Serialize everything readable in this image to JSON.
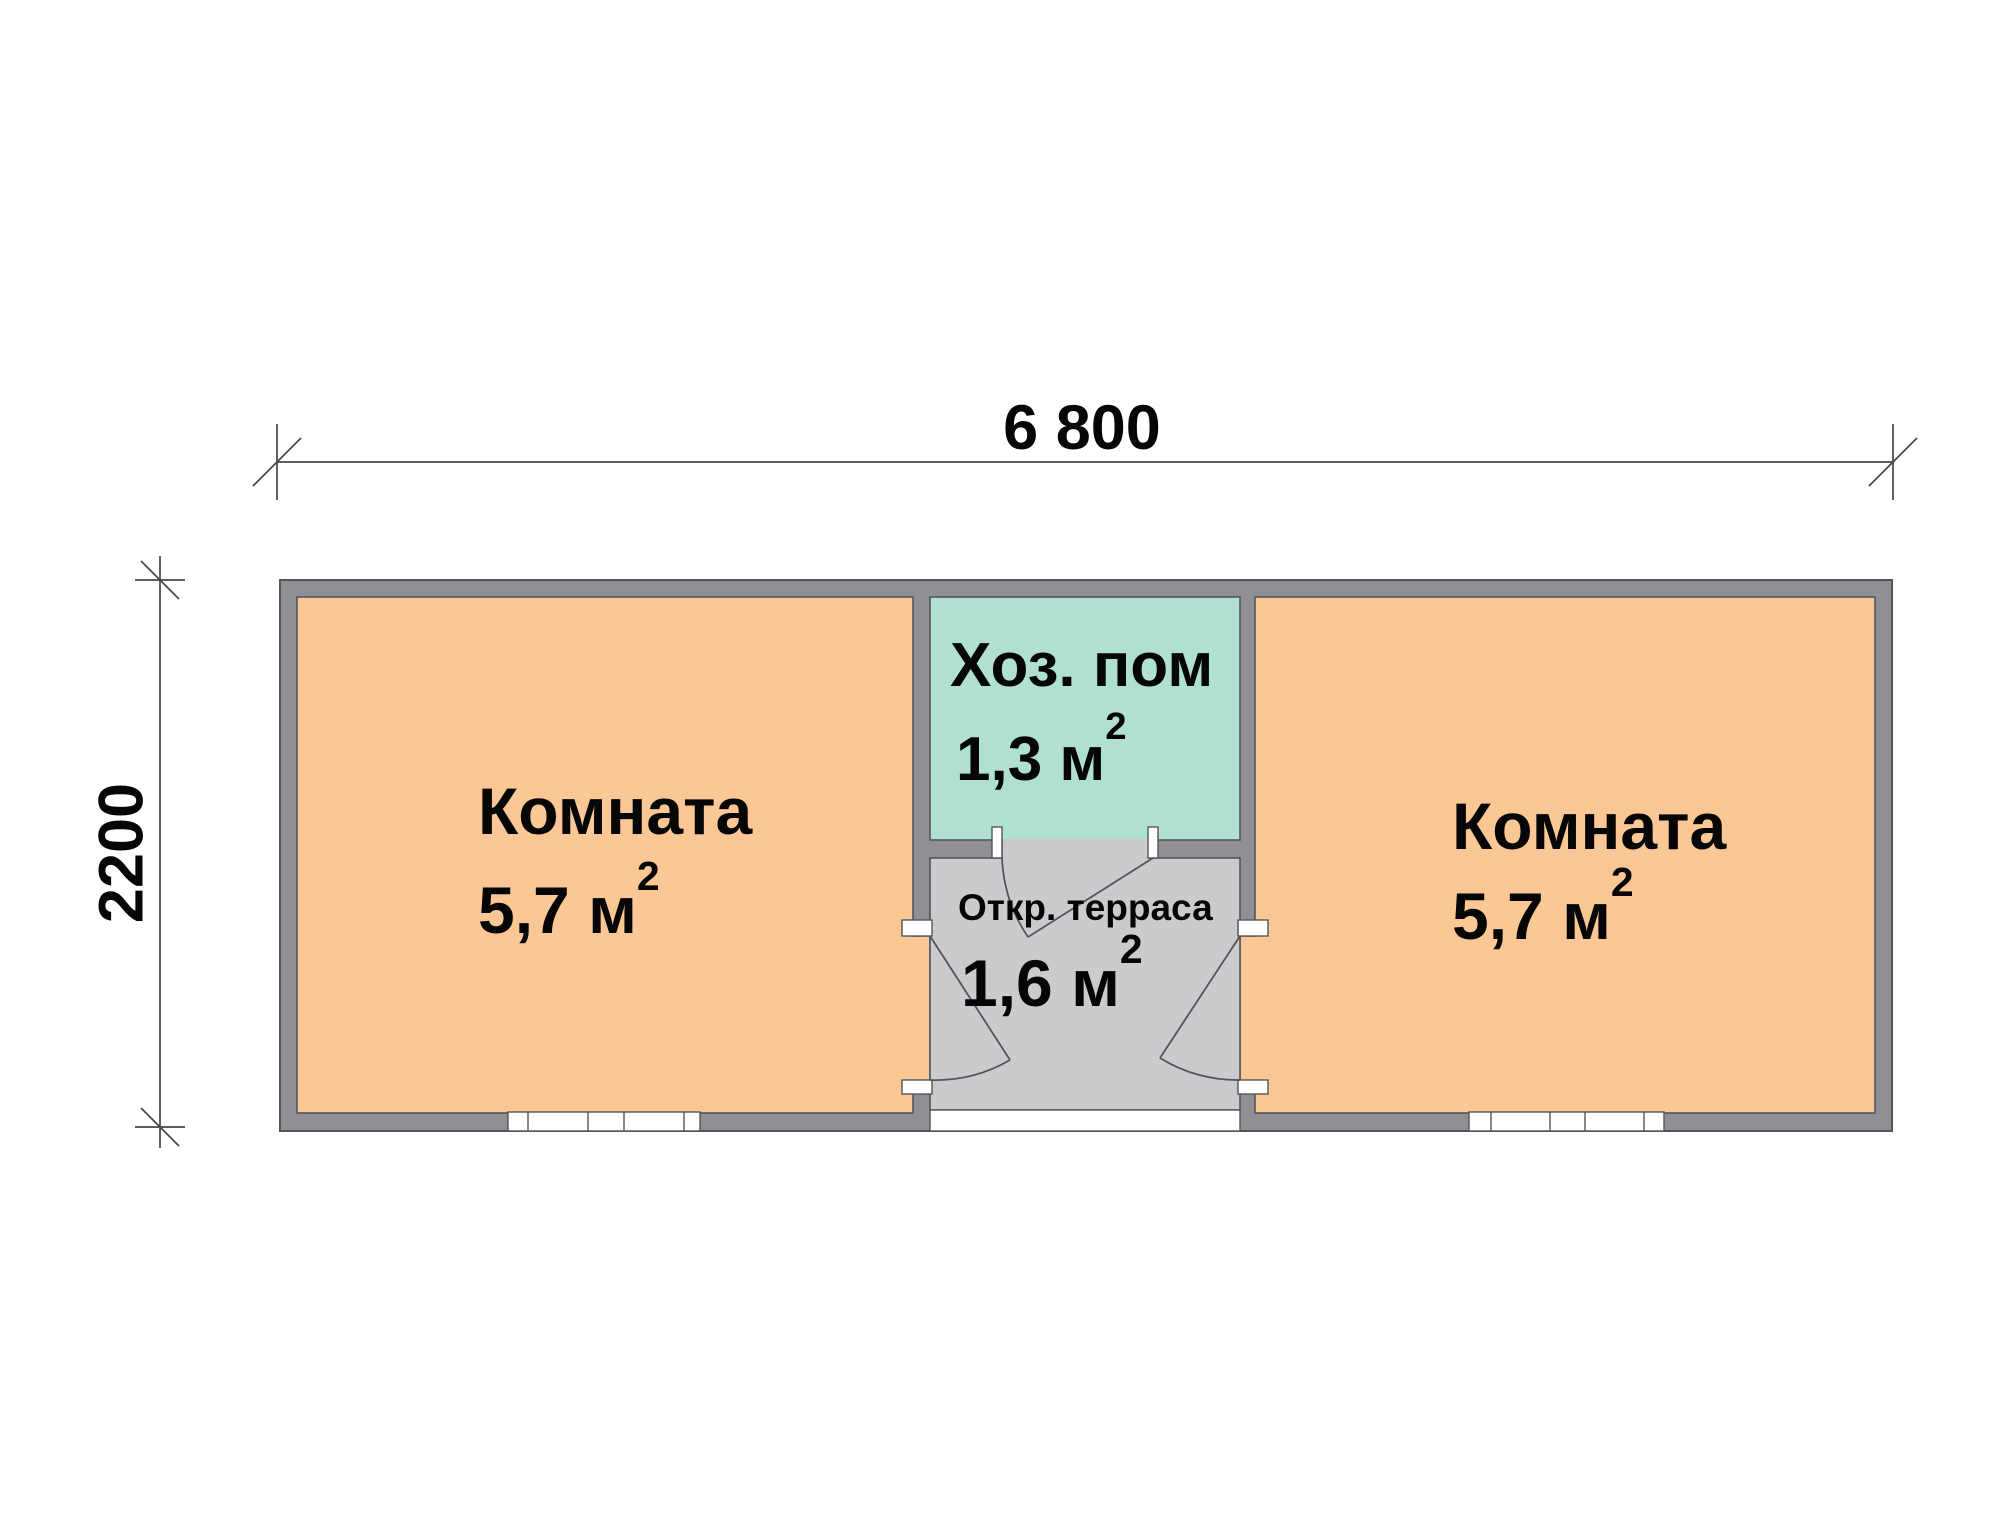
{
  "plan": {
    "dimensions": {
      "width": "6 800",
      "height": "2200"
    },
    "rooms": {
      "left": {
        "name": "Комната",
        "area": "5,7 м",
        "area_exp": "2"
      },
      "right": {
        "name": "Комната",
        "area": "5,7 м",
        "area_exp": "2"
      },
      "utility": {
        "name": "Хоз. пом",
        "area": "1,3 м",
        "area_exp": "2"
      },
      "terrace": {
        "name": "Откр. терраса",
        "area": "1,6 м",
        "area_exp": "2"
      }
    },
    "colors": {
      "room_fill": "#FAC795",
      "utility_fill": "#AFE0D0",
      "terrace_fill": "#CBCBCE",
      "wall_fill": "#8F9094",
      "outline": "#54555A",
      "window_fill": "#FFFFFF",
      "background": "#FFFFFF"
    }
  }
}
